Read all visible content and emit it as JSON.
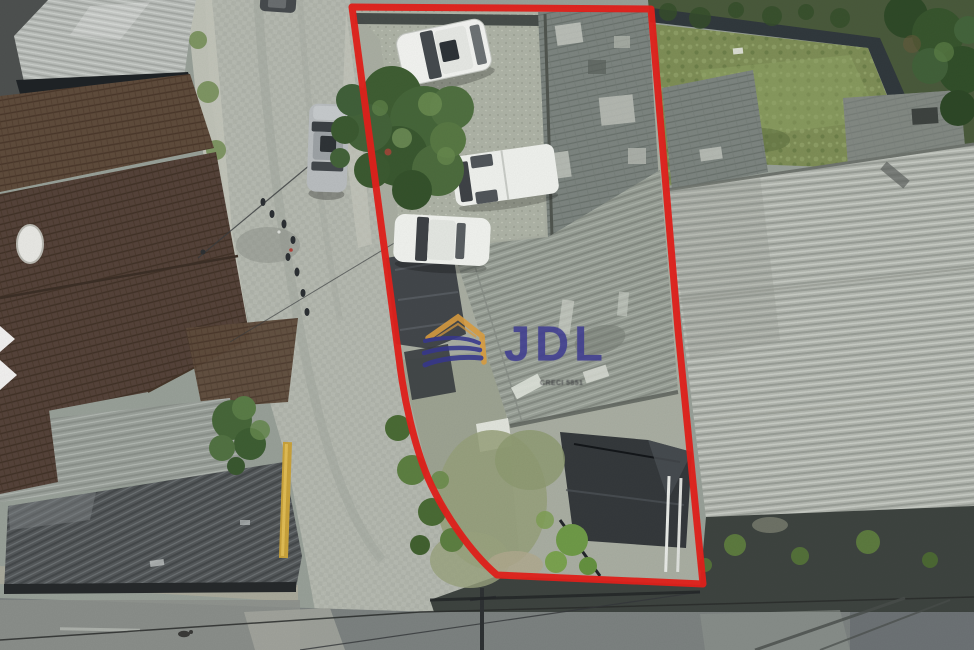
{
  "photo": {
    "type": "aerial-drone-photograph",
    "subject": "Top-down aerial view of an urban corner lot outlined with a red boundary, with rooftops, parked cars, a cobblestone street, warehouse roofs and a road below",
    "boundary_color": "#e2211c"
  },
  "watermark": {
    "brand": "JDL",
    "creci": "CRECI 5851",
    "brand_color": "#3f3d90",
    "roof_icon_color": "#d89b3e",
    "fan_icon_color": "#36378c"
  },
  "scene": {
    "marked_lot": "property outlined in red",
    "vehicles": [
      "white hatchback",
      "white van",
      "white sedan",
      "silver car on street"
    ],
    "surroundings": [
      "tile-roof houses",
      "corrugated warehouse roof",
      "grass yard",
      "cobblestone street",
      "asphalt road with power lines"
    ]
  }
}
